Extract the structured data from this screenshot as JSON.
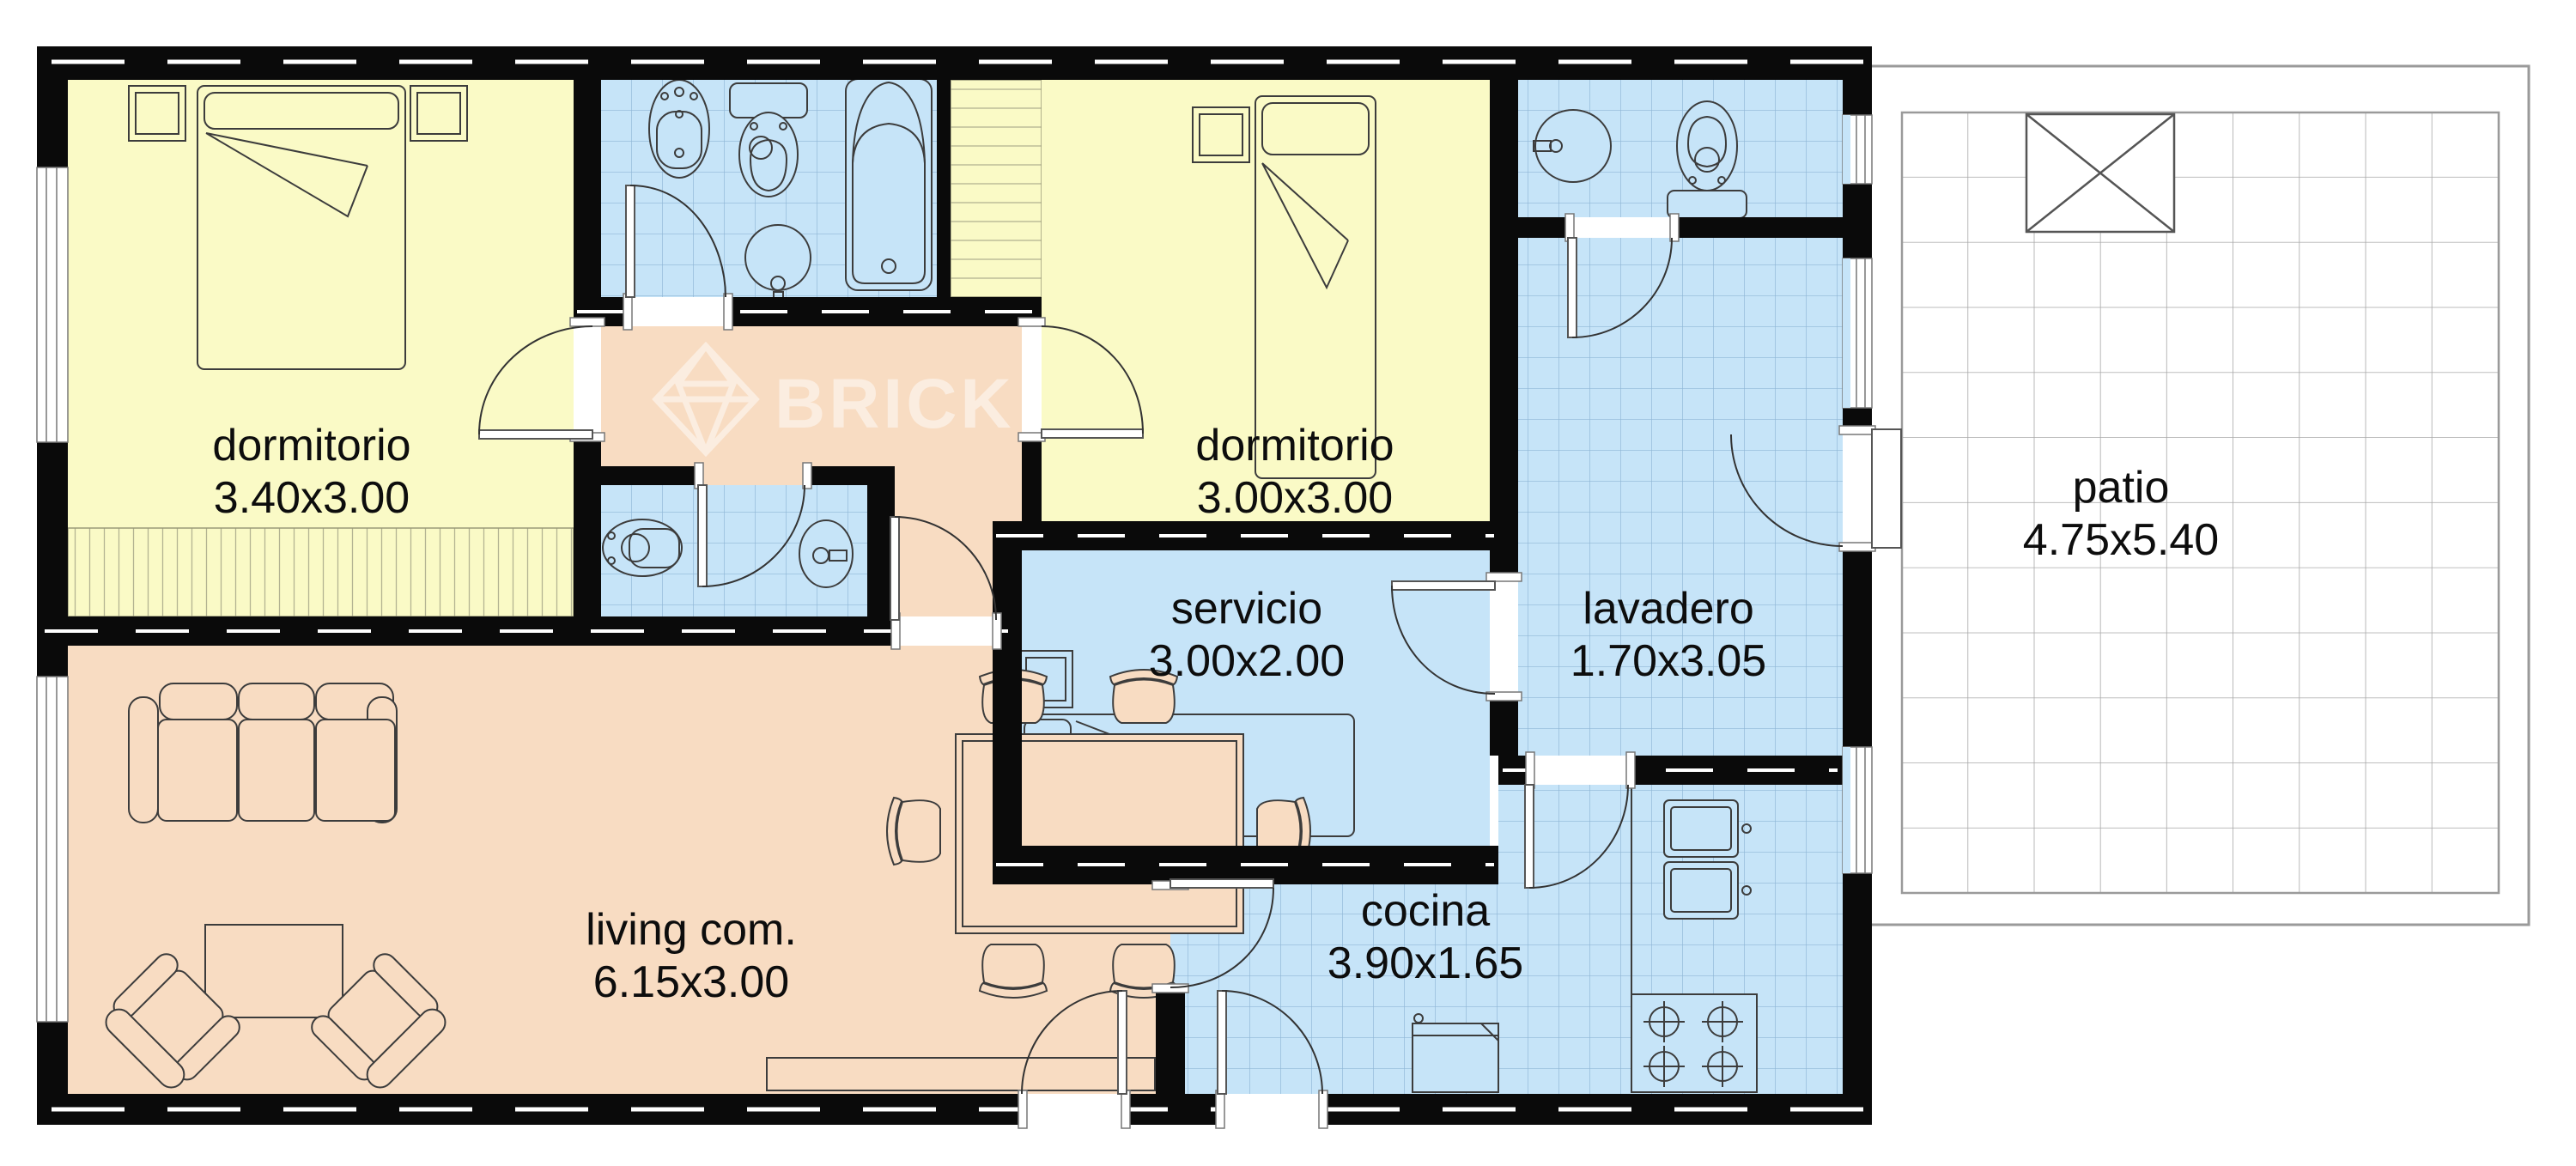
{
  "plan": {
    "title": "apartment floor plan",
    "watermark": {
      "brand": "BRICK"
    },
    "rooms": [
      {
        "id": "dormitorio1",
        "name": "dormitorio",
        "dims": "3.40x3.00"
      },
      {
        "id": "dormitorio2",
        "name": "dormitorio",
        "dims": "3.00x3.00"
      },
      {
        "id": "servicio",
        "name": "servicio",
        "dims": "3.00x2.00"
      },
      {
        "id": "lavadero",
        "name": "lavadero",
        "dims": "1.70x3.05"
      },
      {
        "id": "cocina",
        "name": "cocina",
        "dims": "3.90x1.65"
      },
      {
        "id": "living",
        "name": "living com.",
        "dims": "6.15x3.00"
      },
      {
        "id": "patio",
        "name": "patio",
        "dims": "4.75x5.40"
      }
    ],
    "colors": {
      "wall": "#0a0a0a",
      "bedroom": "#FAFAC6",
      "wet_tile": "#C6E4F8",
      "living": "#F8DCC2",
      "patio_line": "#9a9a9a",
      "tile_line": "#8fb6d6",
      "hatch_line": "#b3b392",
      "furniture_line": "#3c3c3c"
    }
  }
}
